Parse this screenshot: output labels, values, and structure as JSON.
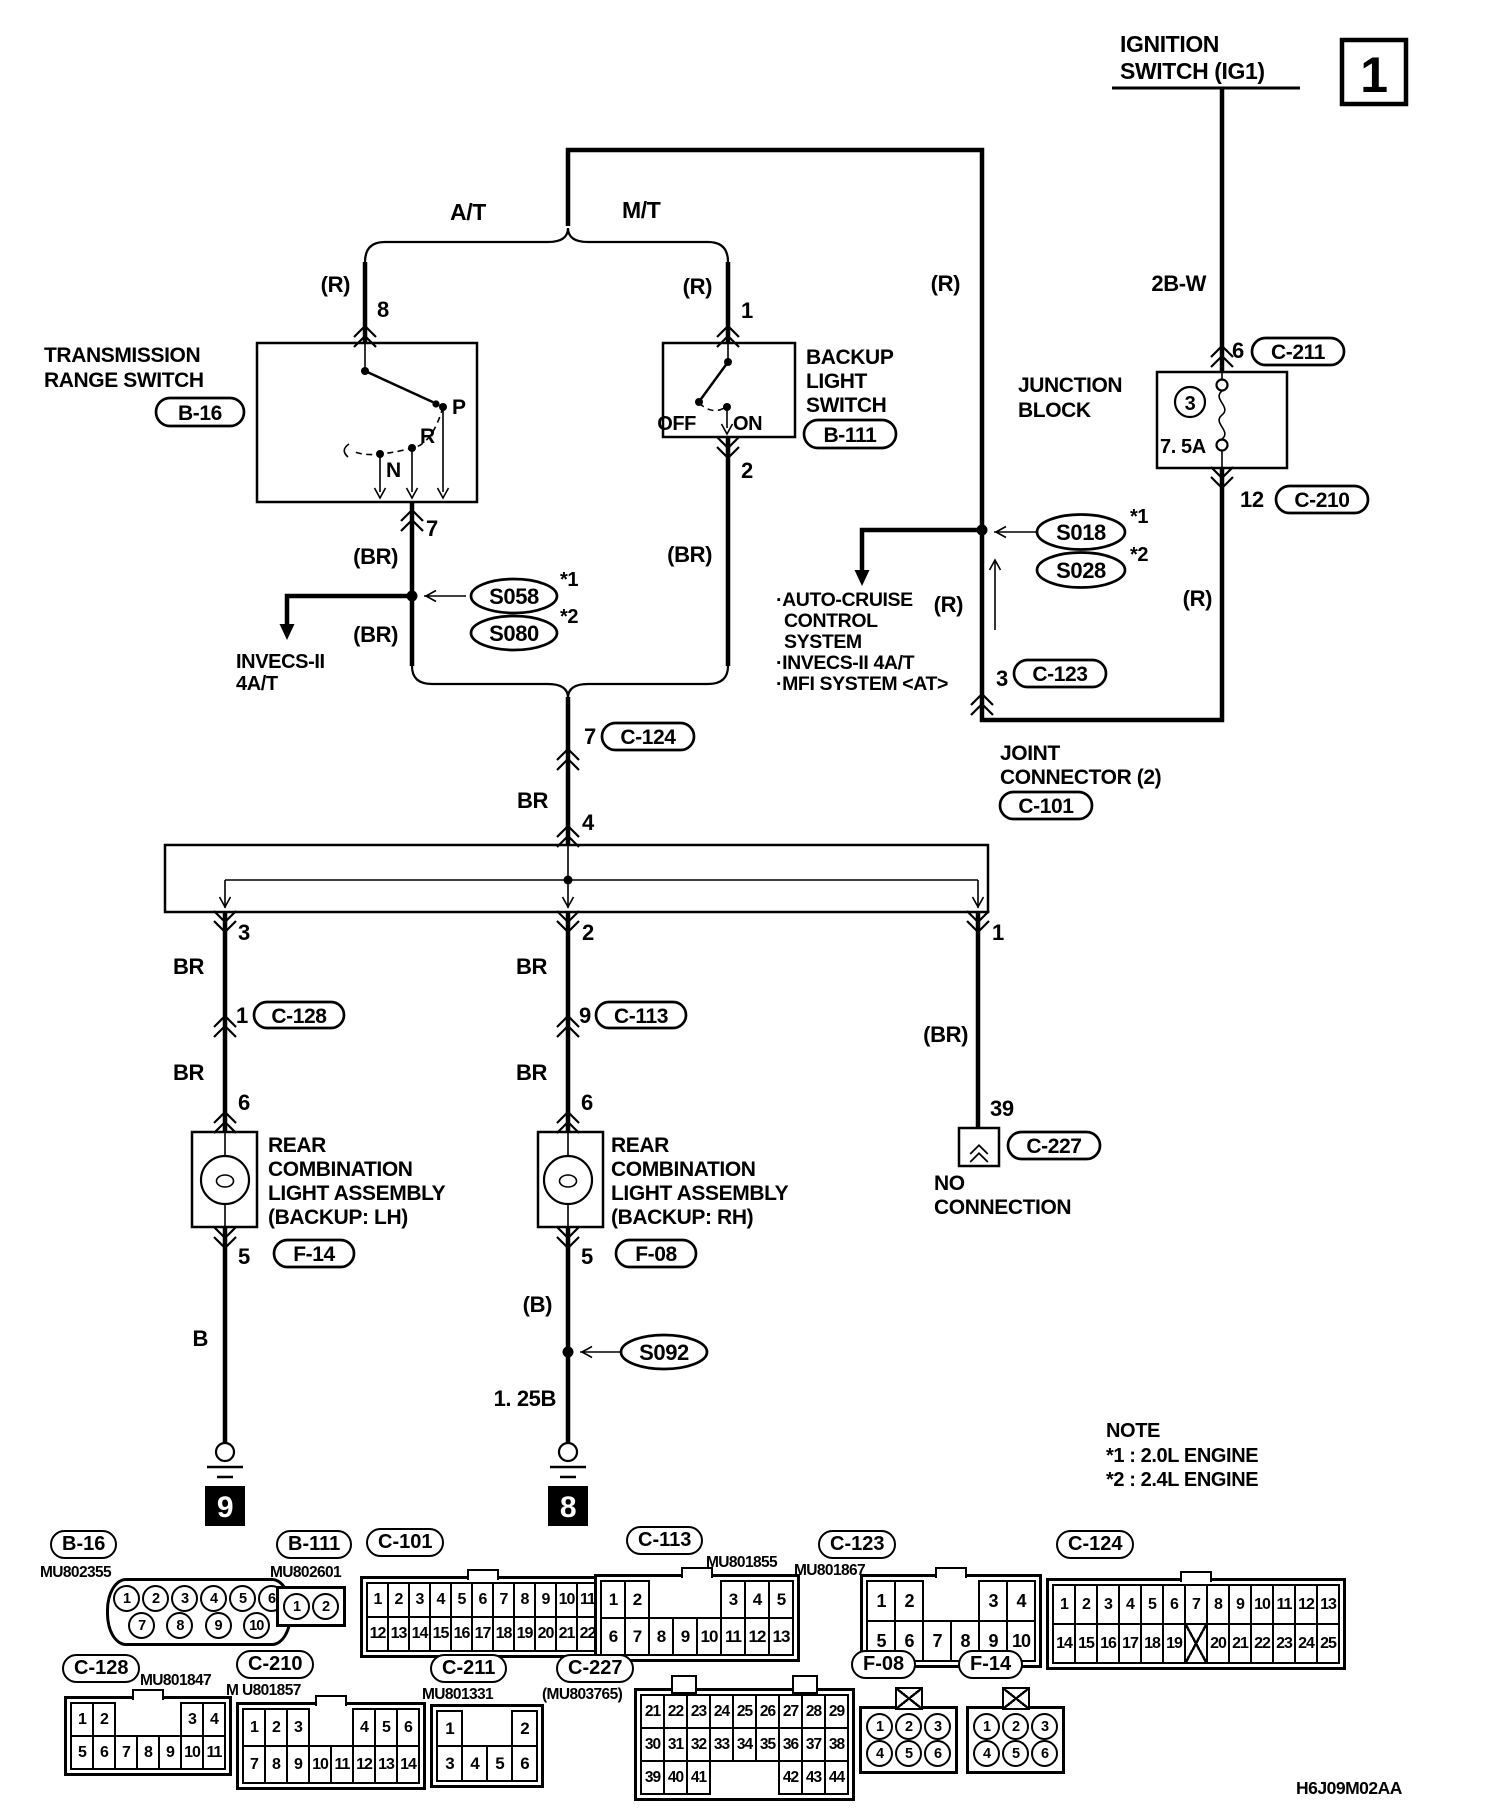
{
  "sheet": {
    "number": "1",
    "code": "H6J09M02AA"
  },
  "note": {
    "title": "NOTE",
    "l1": "*1 : 2.0L ENGINE",
    "l2": "*2 : 2.4L ENGINE"
  },
  "power": {
    "ign1": "IGNITION",
    "ign2": "SWITCH (IG1)",
    "wire": "2B-W",
    "pin6": "6",
    "c211": "C-211",
    "jb1": "JUNCTION",
    "jb2": "BLOCK",
    "fuse_no": "3",
    "fuse_amp": "7. 5A",
    "pin12": "12",
    "c210": "C-210",
    "r_w1": "(R)",
    "r_top": "(R)",
    "r_mid": "(R)"
  },
  "splice": {
    "s018": "S018",
    "s018n": "*1",
    "s028": "S028",
    "s028n": "*2",
    "s058": "S058",
    "s058n": "*1",
    "s080": "S080",
    "s080n": "*2",
    "s092": "S092"
  },
  "ac": {
    "l1": "·AUTO-CRUISE",
    "l2": "CONTROL",
    "l3": "SYSTEM",
    "l4": "·INVECS-II 4A/T",
    "l5": "·MFI SYSTEM <AT>",
    "pin": "3",
    "tag": "C-123"
  },
  "at": {
    "label": "A/T",
    "r": "(R)",
    "pin_in": "8",
    "name1": "TRANSMISSION",
    "name2": "RANGE SWITCH",
    "tag": "B-16",
    "p": "P",
    "rr": "R",
    "n": "N",
    "pin_out": "7",
    "br1": "(BR)",
    "br2": "(BR)",
    "inv1": "INVECS-II",
    "inv2": "4A/T"
  },
  "mt": {
    "label": "M/T",
    "r": "(R)",
    "pin_in": "1",
    "name1": "BACKUP",
    "name2": "LIGHT",
    "name3": "SWITCH",
    "tag": "B-111",
    "off": "OFF",
    "on": "ON",
    "pin_out": "2",
    "br": "(BR)"
  },
  "trunk": {
    "pin7": "7",
    "tag": "C-124",
    "br": "BR",
    "pin4": "4"
  },
  "jc": {
    "l1": "JOINT",
    "l2": "CONNECTOR (2)",
    "tag": "C-101",
    "pin3": "3",
    "pin2": "2",
    "pin1": "1"
  },
  "lh": {
    "br1": "BR",
    "pin1": "1",
    "ctag": "C-128",
    "br2": "BR",
    "pin6": "6",
    "n1": "REAR",
    "n2": "COMBINATION",
    "n3": "LIGHT ASSEMBLY",
    "n4": "(BACKUP: LH)",
    "tag": "F-14",
    "pin5": "5",
    "b": "B",
    "gnd": "9"
  },
  "rh": {
    "br1": "BR",
    "pin9": "9",
    "ctag": "C-113",
    "br2": "BR",
    "pin6": "6",
    "n1": "REAR",
    "n2": "COMBINATION",
    "n3": "LIGHT ASSEMBLY",
    "n4": "(BACKUP: RH)",
    "tag": "F-08",
    "pin5": "5",
    "b": "(B)",
    "w125": "1. 25B",
    "gnd": "8"
  },
  "nc": {
    "br": "(BR)",
    "pin": "39",
    "tag": "C-227",
    "l1": "NO",
    "l2": "CONNECTION"
  },
  "connectors": [
    {
      "id": "B-16",
      "part": "MU802355",
      "style": "circles-trap",
      "rows": [
        [
          "1",
          "2",
          "3",
          "4",
          "5",
          "6"
        ],
        [
          "7",
          "8",
          "9",
          "10"
        ]
      ]
    },
    {
      "id": "B-111",
      "part": "MU802601",
      "style": "circles",
      "rows": [
        [
          "1",
          "2"
        ]
      ]
    },
    {
      "id": "C-101",
      "part": "",
      "style": "cells",
      "rows": [
        [
          "1",
          "2",
          "3",
          "4",
          "5",
          "6",
          "7",
          "8",
          "9",
          "10",
          "11"
        ],
        [
          "12",
          "13",
          "14",
          "15",
          "16",
          "17",
          "18",
          "19",
          "20",
          "21",
          "22"
        ]
      ]
    },
    {
      "id": "C-113",
      "part": "MU801855",
      "style": "cells",
      "rows": [
        [
          "1",
          "2",
          "",
          "",
          "",
          "3",
          "4",
          "5"
        ],
        [
          "6",
          "7",
          "8",
          "9",
          "10",
          "11",
          "12",
          "13"
        ]
      ]
    },
    {
      "id": "C-123",
      "part": "MU801867",
      "style": "cells",
      "rows": [
        [
          "1",
          "2",
          "",
          "",
          "3",
          "4"
        ],
        [
          "5",
          "6",
          "7",
          "8",
          "9",
          "10"
        ]
      ]
    },
    {
      "id": "C-124",
      "part": "",
      "style": "cells",
      "rows": [
        [
          "1",
          "2",
          "3",
          "4",
          "5",
          "6",
          "7",
          "8",
          "9",
          "10",
          "11",
          "12",
          "13"
        ],
        [
          "14",
          "15",
          "16",
          "17",
          "18",
          "19",
          "X",
          "20",
          "21",
          "22",
          "23",
          "24",
          "25"
        ]
      ]
    },
    {
      "id": "C-128",
      "part": "MU801847",
      "style": "cells",
      "rows": [
        [
          "1",
          "2",
          "",
          "",
          "",
          "3",
          "4"
        ],
        [
          "5",
          "6",
          "7",
          "8",
          "9",
          "10",
          "11"
        ]
      ]
    },
    {
      "id": "C-210",
      "part": "M U801857",
      "style": "cells",
      "rows": [
        [
          "1",
          "2",
          "3",
          "",
          "",
          "4",
          "5",
          "6"
        ],
        [
          "7",
          "8",
          "9",
          "10",
          "11",
          "12",
          "13",
          "14"
        ]
      ]
    },
    {
      "id": "C-211",
      "part": "MU801331",
      "style": "cells",
      "rows": [
        [
          "1",
          "",
          "",
          "2"
        ],
        [
          "3",
          "4",
          "5",
          "6"
        ]
      ]
    },
    {
      "id": "C-227",
      "part": "(MU803765)",
      "style": "cells",
      "rows": [
        [
          "21",
          "22",
          "23",
          "24",
          "25",
          "26",
          "27",
          "28",
          "29"
        ],
        [
          "30",
          "31",
          "32",
          "33",
          "34",
          "35",
          "36",
          "37",
          "38"
        ],
        [
          "39",
          "40",
          "41",
          "",
          "",
          "",
          "42",
          "43",
          "44"
        ]
      ]
    },
    {
      "id": "F-08",
      "part": "",
      "style": "circles-x",
      "rows": [
        [
          "1",
          "2",
          "3"
        ],
        [
          "4",
          "5",
          "6"
        ]
      ]
    },
    {
      "id": "F-14",
      "part": "",
      "style": "circles-x",
      "rows": [
        [
          "1",
          "2",
          "3"
        ],
        [
          "4",
          "5",
          "6"
        ]
      ]
    }
  ]
}
